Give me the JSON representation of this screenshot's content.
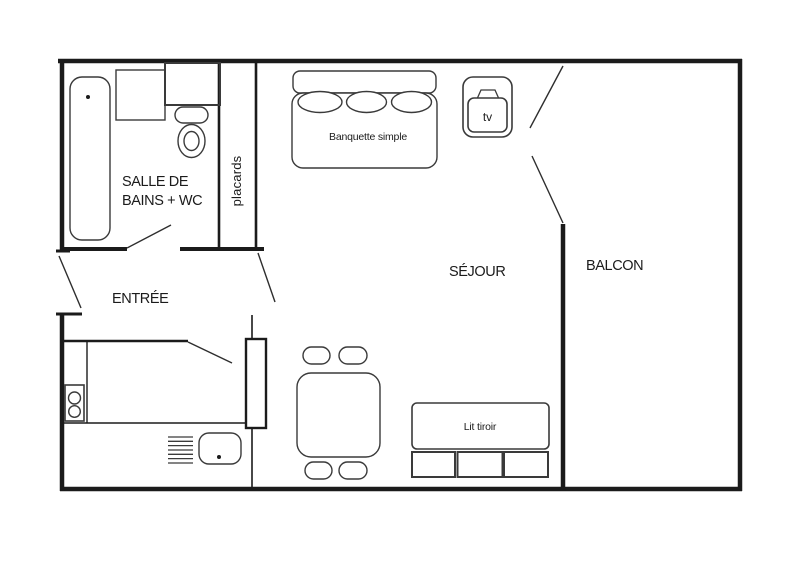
{
  "palette": {
    "ink": "#1b1b1b",
    "furniture_ink": "#3a3a3a",
    "background": "#ffffff"
  },
  "rooms": {
    "bathroom": {
      "label_line1": "SALLE DE",
      "label_line2": "BAINS + WC"
    },
    "closets": {
      "label": "placards"
    },
    "entrance": {
      "label": "ENTRÉE"
    },
    "living_room": {
      "label": "SÉJOUR"
    },
    "balcony": {
      "label": "BALCON"
    }
  },
  "furniture": {
    "banquette": {
      "label": "Banquette simple"
    },
    "tv": {
      "label": "tv"
    },
    "drawer_bed": {
      "label": "Lit tiroir"
    }
  }
}
